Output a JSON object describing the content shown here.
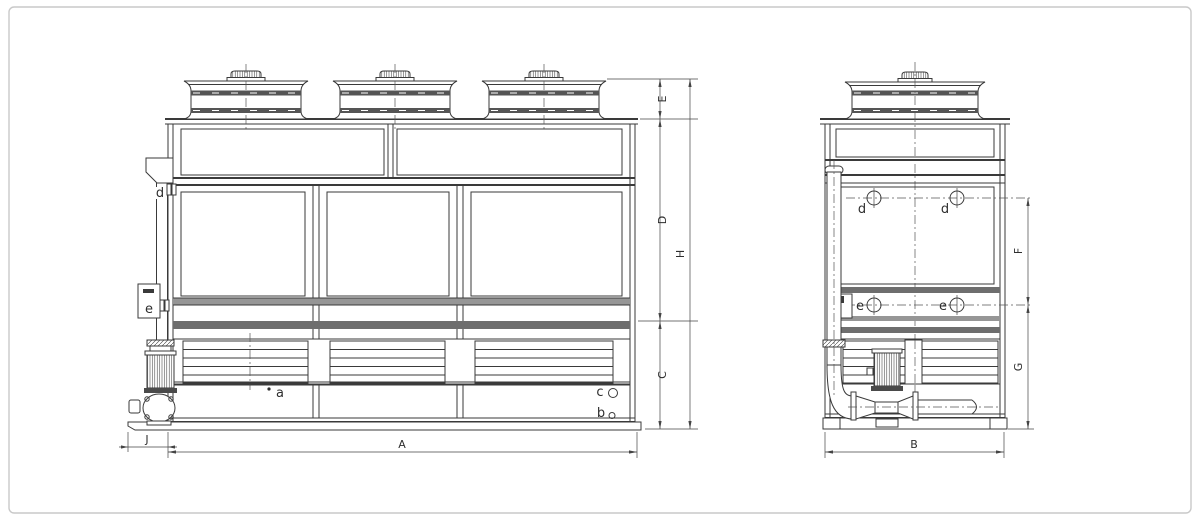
{
  "colors": {
    "line": "#3a3a3a",
    "band_dark": "#6e6e6e",
    "band_light": "#969696",
    "background": "#ffffff",
    "frame_border": "#c9c9c9"
  },
  "front_view": {
    "dims": {
      "A": "A",
      "J": "J",
      "C": "C",
      "D": "D",
      "E": "E",
      "H": "H"
    },
    "ports": {
      "a": "a",
      "b": "b",
      "c": "c",
      "d": "d",
      "e": "e"
    }
  },
  "side_view": {
    "dims": {
      "B": "B",
      "F": "F",
      "G": "G"
    },
    "ports": {
      "d_front": "d",
      "d_rear": "d",
      "e_front": "e",
      "e_rear": "e"
    }
  }
}
